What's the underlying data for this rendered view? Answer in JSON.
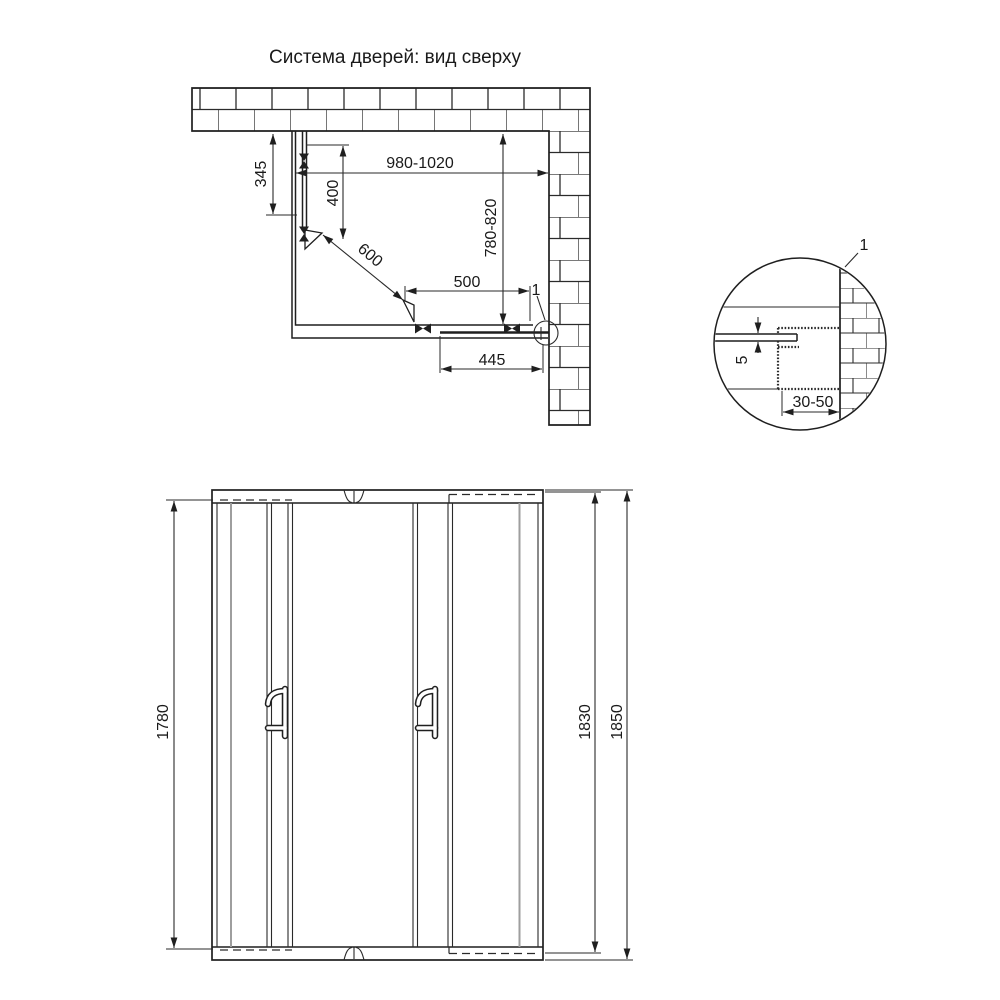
{
  "title": "Система дверей: вид сверху",
  "colors": {
    "line": "#1f1f1f",
    "dim_line": "#2a2a2a",
    "gray_panel_line": "#9e9e9e",
    "background": "#ffffff"
  },
  "top_view": {
    "labels": {
      "wall_offset": "345",
      "fixed_panel": "400",
      "system_width": "980-1020",
      "side_depth": "780-820",
      "diagonal_entry": "600",
      "door_opening": "500",
      "door_panel": "445",
      "detail_ref": "1"
    }
  },
  "detail_view": {
    "labels": {
      "ref": "1",
      "glass_thickness": "5",
      "profile_adjust": "30-50"
    }
  },
  "front_view": {
    "labels": {
      "glass_height": "1780",
      "door_height": "1830",
      "total_height": "1850"
    }
  }
}
